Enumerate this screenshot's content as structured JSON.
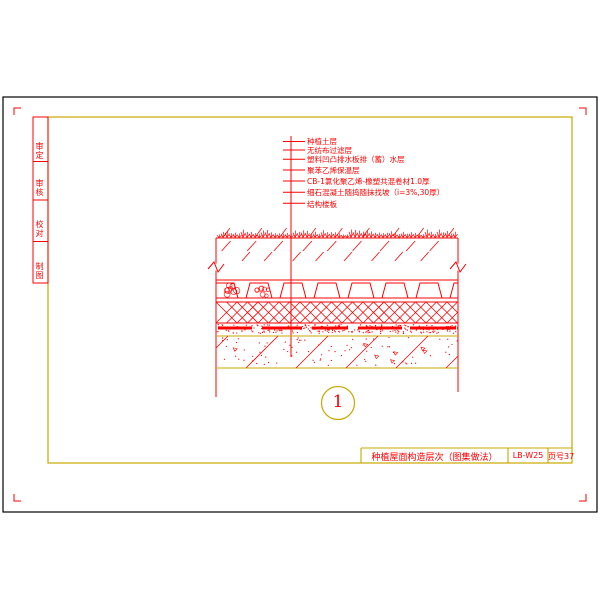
{
  "colors": {
    "line_red": "#ff0000",
    "line_yellow": "#c8a800",
    "line_black": "#000000",
    "background": "#ffffff"
  },
  "margin_fields": [
    {
      "label": "审定"
    },
    {
      "label": "审核"
    },
    {
      "label": "校对"
    },
    {
      "label": "制图"
    }
  ],
  "callouts": {
    "labels": [
      {
        "text": "种植土层"
      },
      {
        "text": "无纺布过滤层"
      },
      {
        "text": "塑料凹凸排水板排（蓄）水层"
      },
      {
        "text": "聚苯乙烯保温层"
      },
      {
        "text": "CB-1氯化聚乙烯-橡塑共混卷材1.0厚"
      },
      {
        "text": "细石混凝土随捣随抹找坡（i=3%,30厚）"
      },
      {
        "text": "结构楼板"
      }
    ]
  },
  "section_layers_note": "屋面种植构造剖面：种植土-过滤层-排水板-保温层-防水卷材-找坡层-结构楼板",
  "detail_bubble": {
    "number": "1"
  },
  "title_block": {
    "title": "种植屋面构造层次（图集做法）",
    "drawing_no": "LB-W25",
    "page_no": "页号37"
  }
}
